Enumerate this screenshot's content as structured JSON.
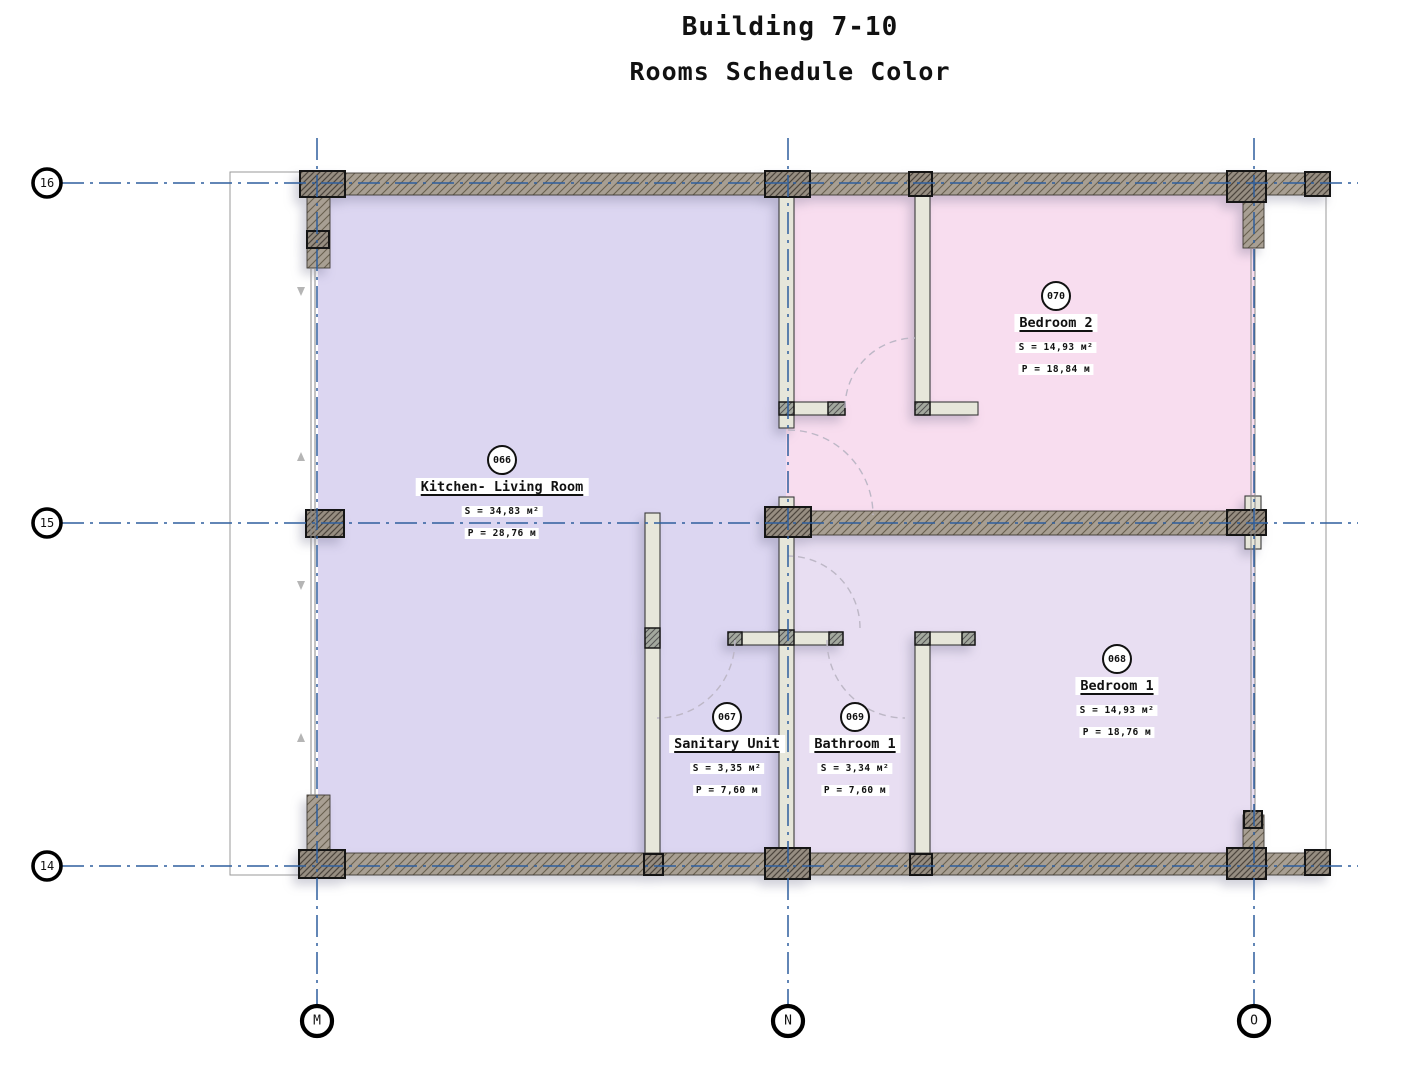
{
  "title": {
    "line1": "Building 7-10",
    "line2": "Rooms Schedule Color"
  },
  "rooms": [
    {
      "tag": "066",
      "name": "Kitchen- Living Room",
      "area": "S = 34,83 м²",
      "perimeter": "P = 28,76 м"
    },
    {
      "tag": "070",
      "name": "Bedroom 2",
      "area": "S = 14,93 м²",
      "perimeter": "P = 18,84 м"
    },
    {
      "tag": "067",
      "name": "Sanitary Unit",
      "area": "S = 3,35 м²",
      "perimeter": "P = 7,60 м"
    },
    {
      "tag": "069",
      "name": "Bathroom 1",
      "area": "S = 3,34 м²",
      "perimeter": "P = 7,60 м"
    },
    {
      "tag": "068",
      "name": "Bedroom 1",
      "area": "S = 14,93 м²",
      "perimeter": "P = 18,76 м"
    }
  ],
  "grid": {
    "rows": [
      {
        "label": "16"
      },
      {
        "label": "15"
      },
      {
        "label": "14"
      }
    ],
    "columns": [
      {
        "label": "M"
      },
      {
        "label": "N"
      },
      {
        "label": "O"
      }
    ]
  },
  "colors": {
    "grid_line": "#2e5f9e",
    "wall_fill": "#a89f93",
    "room_kitchen": "#dcd6f1",
    "room_bedroom2": "#f8ddef",
    "room_bedroom1": "#e8def2",
    "partition": "#e6e6da"
  }
}
